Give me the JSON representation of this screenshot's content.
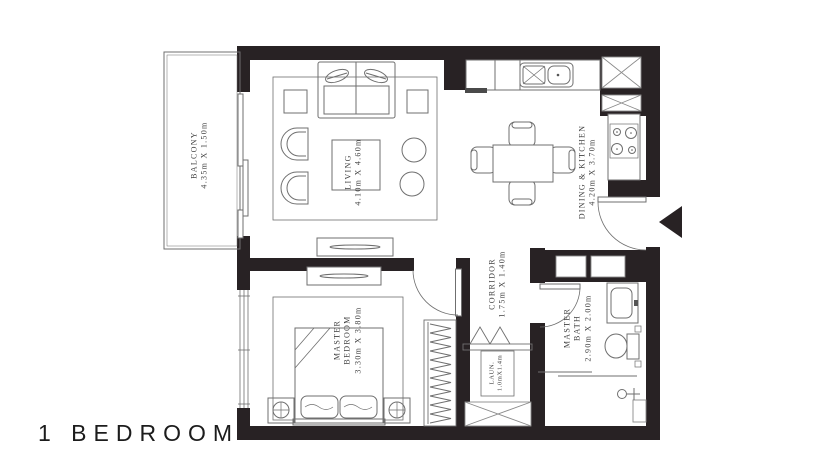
{
  "title": "1 BEDROOM",
  "colors": {
    "wall": "#282224",
    "line": "#6f6f6f",
    "text": "#414141"
  },
  "rooms": {
    "balcony": {
      "name": "BALCONY",
      "dims": "4.35m X 1.50m"
    },
    "living": {
      "name": "LIVING",
      "dims": "4.10m X 4.60m"
    },
    "dining_kitchen": {
      "name": "DINING & KITCHEN",
      "dims": "4.20m X 3.70m"
    },
    "corridor": {
      "name": "CORRIDOR",
      "dims": "1.75m X 1.40m"
    },
    "master_bedroom": {
      "name": "MASTER",
      "name2": "BEDROOM",
      "dims": "3.30m X 3.80m"
    },
    "master_bath": {
      "name": "MASTER",
      "name2": "BATH",
      "dims": "2.90m X 2.00m"
    },
    "laundry": {
      "name": "LAUN.",
      "dims": "1.0mX1.4m"
    }
  }
}
